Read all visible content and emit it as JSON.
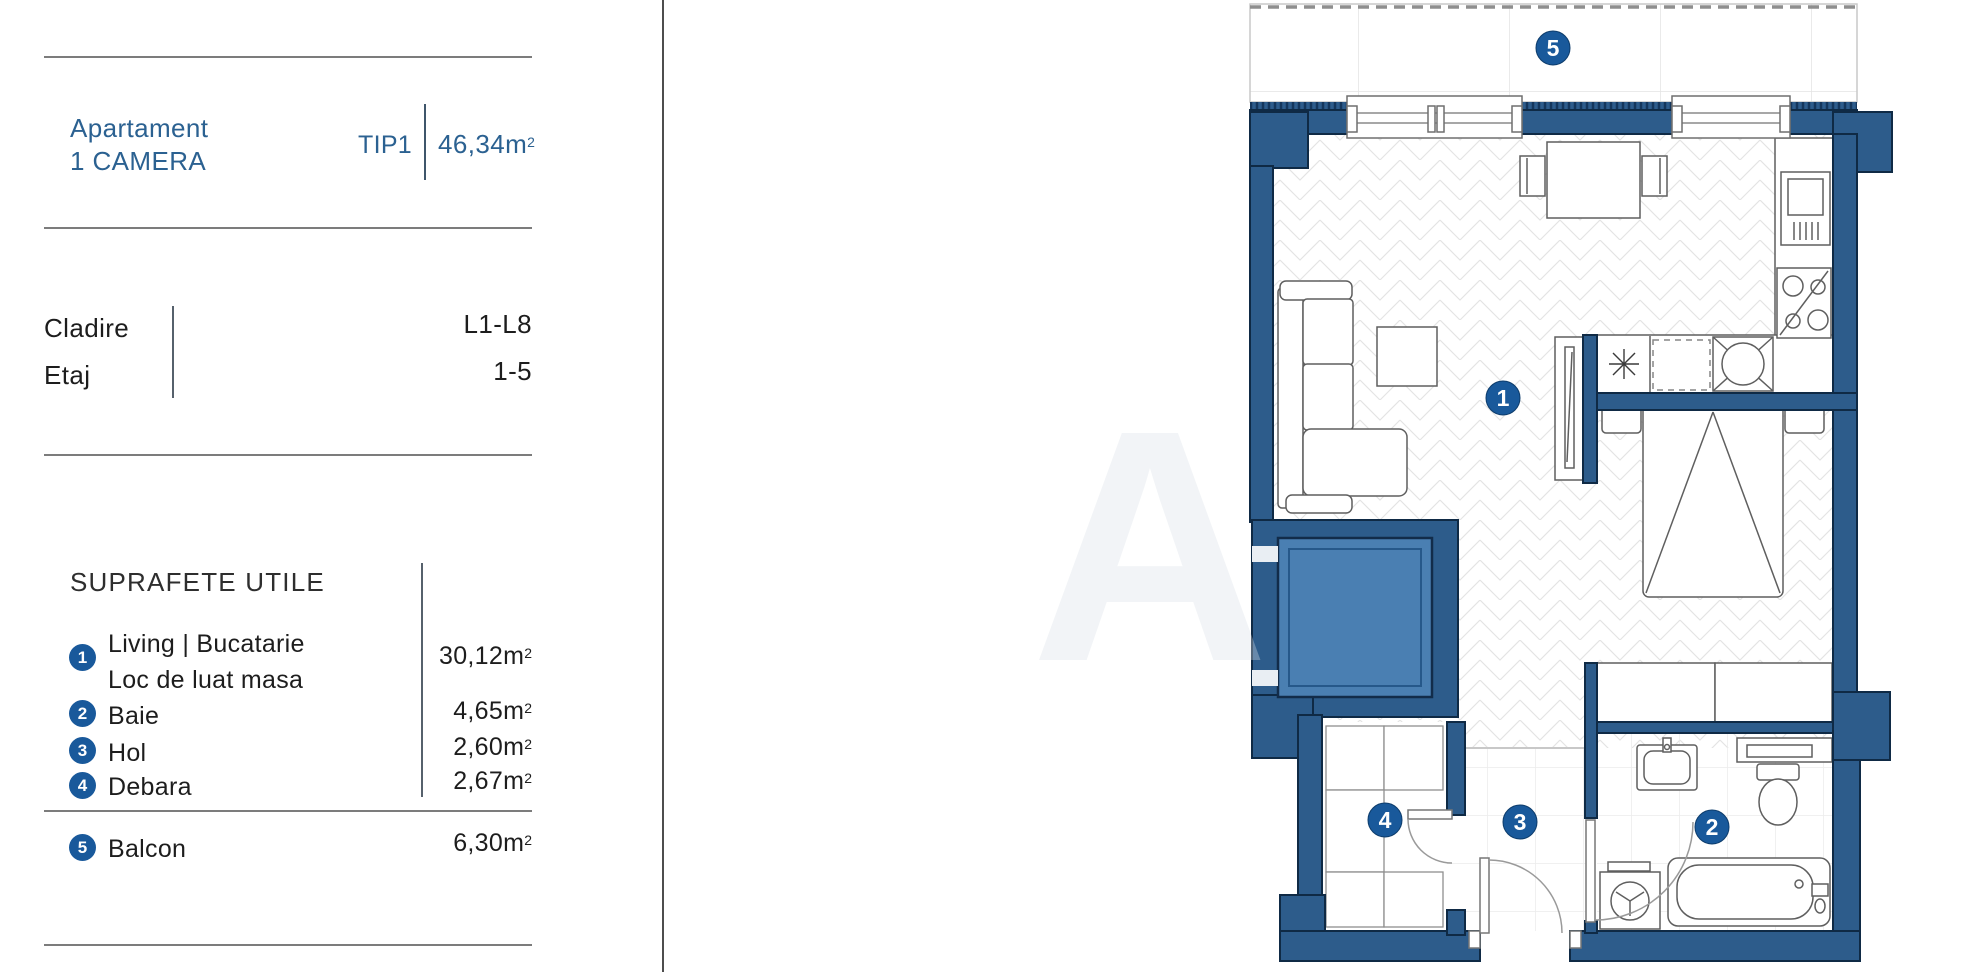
{
  "panel": {
    "title_line1": "Apartament",
    "title_line2": "1 CAMERA",
    "type_label": "TIP1",
    "area_value": "46,34",
    "unit_base": "m",
    "unit_sup": "2",
    "building_label": "Cladire",
    "building_value": "L1-L8",
    "floor_label": "Etaj",
    "floor_value": "1-5",
    "section_title": "SUPRAFETE UTILE",
    "rooms": [
      {
        "n": "1",
        "name_line1": "Living | Bucatarie",
        "name_line2": "Loc de luat masa",
        "area": "30,12"
      },
      {
        "n": "2",
        "name": "Baie",
        "area": "4,65"
      },
      {
        "n": "3",
        "name": "Hol",
        "area": "2,60"
      },
      {
        "n": "4",
        "name": "Debara",
        "area": "2,67"
      },
      {
        "n": "5",
        "name": "Balcon",
        "area": "6,30"
      }
    ]
  },
  "watermark": {
    "letter": "A"
  },
  "colors": {
    "wall_blue": "#2d5c8b",
    "wall_outline": "#0f2a45",
    "elevator_cab_blue": "#4a7fb2",
    "badge_blue": "#19599b",
    "accent_text_blue": "#2b6191",
    "text_dark": "#1d1d1d"
  }
}
